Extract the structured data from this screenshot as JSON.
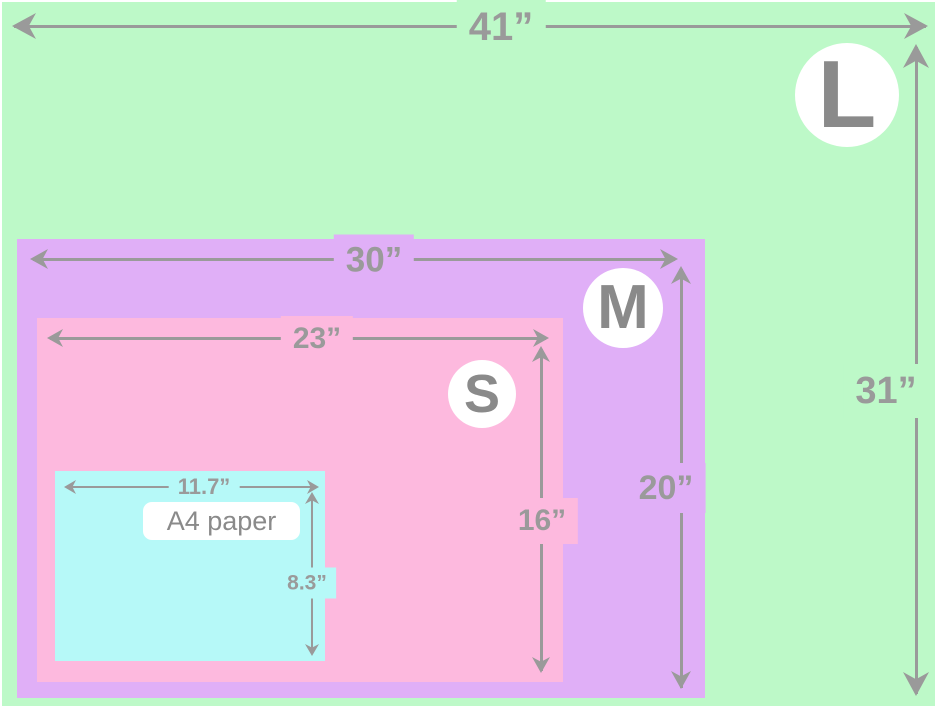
{
  "diagram": {
    "description": "Nested size comparison of three print sizes and A4 paper"
  },
  "colors": {
    "page_bg": "#ffffff",
    "surface_l": "#bdf9c8",
    "surface_m": "#e0aff7",
    "surface_s": "#fdb9de",
    "surface_a4": "#b6f9f8",
    "dim_gray": "#9a9a9a",
    "badge_letter": "#8a8a8a",
    "badge_bg": "#ffffff"
  },
  "sizes": {
    "large": {
      "badge": "L",
      "width_label": "41”",
      "height_label": "31”"
    },
    "medium": {
      "badge": "M",
      "width_label": "30”",
      "height_label": "20”"
    },
    "small": {
      "badge": "S",
      "width_label": "23”",
      "height_label": "16”"
    },
    "a4": {
      "label": "A4 paper",
      "width_label": "11.7”",
      "height_label": "8.3”"
    }
  }
}
